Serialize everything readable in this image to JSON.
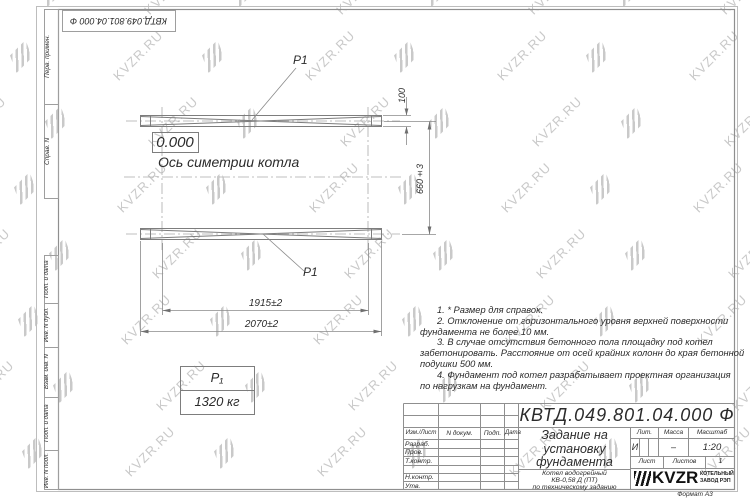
{
  "watermark": {
    "text": "KVZR.RU"
  },
  "top_stamp": {
    "doc_number_inverted": "КВТД.049.801.04.000  Ф"
  },
  "margin_columns": {
    "perv_primen": "Перв. примен.",
    "sprav_n": "Справ. N",
    "podp_data_upper": "Подп. и дата",
    "inv_dubl": "Инв. N дубл.",
    "vzam_inv": "Взам. инв. N",
    "podp_data_lower": "Подп. и дата",
    "inv_podl": "Инв. N подл."
  },
  "drawing": {
    "level_mark": "0.000",
    "axis_label": "Ось симетрии котла",
    "load_point_top": "Р1",
    "load_point_bottom": "Р1",
    "dims": {
      "height_offset": "100",
      "spacing": "660±3",
      "inner_span": "1915±2",
      "outer_span": "2070±2"
    },
    "load_table": {
      "symbol": "Р₁",
      "value": "1320 кг"
    }
  },
  "notes": {
    "lines": [
      "1. * Размер для справок.",
      "2. Отклонение от горизонтального уровня верхней поверхности",
      "фундамента не более 10 мм.",
      "3. В случае отсутствия бетонного пола площадку под котел",
      "забетонировать. Расстояние от осей крайних колонн до края бетонной",
      "подушки 500 мм.",
      "4. Фундамент под котел разрабатывает проектная организация",
      "по нагрузкам на фундамент."
    ]
  },
  "title_block": {
    "doc_number": "КВТД.049.801.04.000  Ф",
    "title_lines": [
      "Задание на",
      "установку",
      "фундамента"
    ],
    "subtitle_lines": [
      "Котел водогрейный",
      "КВ-0,58 Д  (ПТ)",
      "по техническому заданию"
    ],
    "col_headers": {
      "izm_list": "Изм./Лист",
      "n_dokum": "N докум.",
      "podp": "Подп.",
      "data": "Дата"
    },
    "sign_rows": [
      "Разраб.",
      "Пров.",
      "Т.контр.",
      "Н.контр.",
      "Утв."
    ],
    "lit_header": "Лит.",
    "massa_header": "Масса",
    "masshtab_header": "Масштаб",
    "lit_value": "И",
    "massa_value": "–",
    "masshtab_value": "1:20",
    "list_header": "Лист",
    "listov_header": "Листов",
    "listov_value": "1",
    "logo": {
      "text": "KVZR",
      "caption_lines": [
        "КОТЕЛЬНЫЙ",
        "ЗАВОД РЭП"
      ]
    },
    "format_label": "Формат А3"
  }
}
